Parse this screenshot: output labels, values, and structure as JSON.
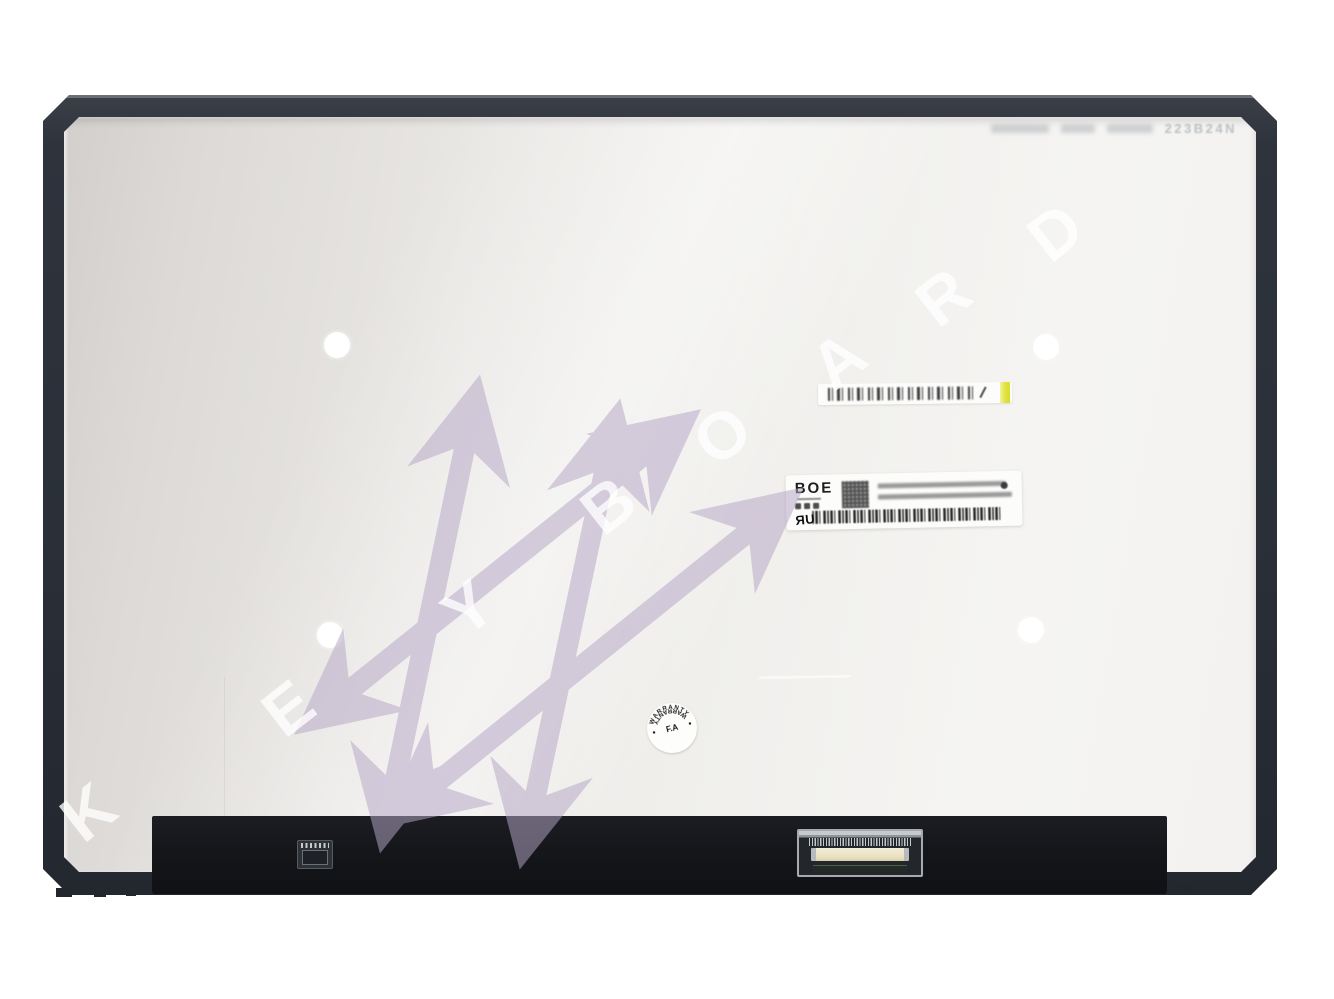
{
  "scene": {
    "description": "Product photo: rear side of a slim laptop LCD screen panel with labels and watermark",
    "background_color": "#ffffff"
  },
  "panel": {
    "etched_text": "223B24N",
    "screw_dot_count": 4,
    "colors": {
      "frame": "#2e333c",
      "metal_light": "#f5f4f2",
      "metal_dark": "#d2cfcc",
      "bottom_strip": "#14161a"
    }
  },
  "labels": {
    "boe": {
      "brand": "BOE",
      "ul_mark": "ЯU"
    },
    "top_sticker": {
      "accent_color": "#e2e545"
    },
    "warranty": {
      "top": "WARRANTY",
      "center": "F.A",
      "bottom": "WARRANTY"
    }
  },
  "watermark": {
    "word": "KEYBOARD",
    "letters": [
      "K",
      "E",
      "Y",
      "B",
      "O",
      "A",
      "R",
      "D"
    ],
    "hash_color": "#b5a6c6",
    "letter_color": "#ffffff"
  },
  "icons": {
    "qr-code-icon": "css-grid-pattern",
    "barcode-icon": "css-bar-pattern",
    "ul-recognized-icon": "ЯU",
    "warranty-seal-icon": "circular-stamp",
    "slash-icon": "\\",
    "cert-marks-icon": "small-dark-blobs"
  }
}
